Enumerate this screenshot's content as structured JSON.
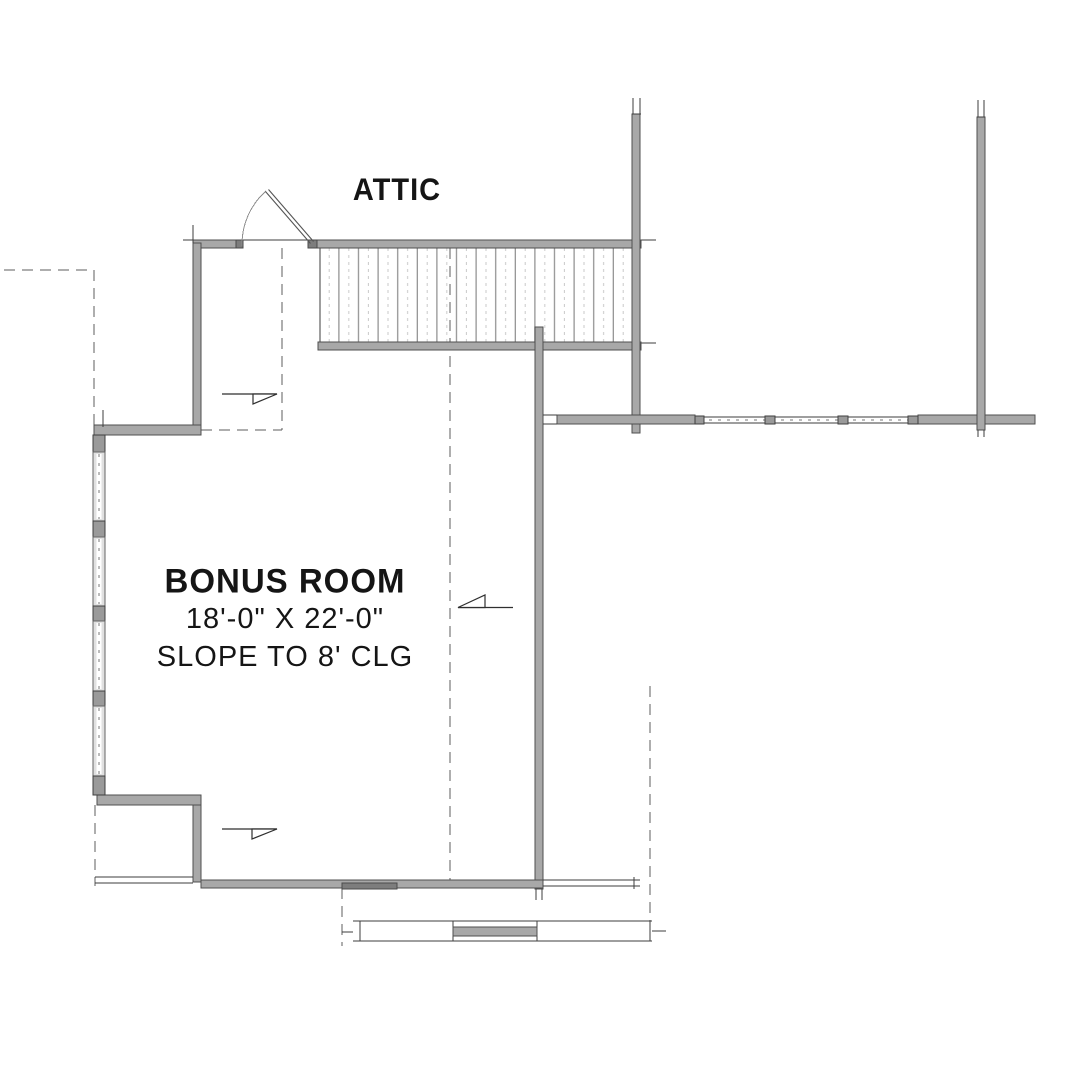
{
  "plan": {
    "attic_label": "ATTIC",
    "room": {
      "name": "BONUS ROOM",
      "dimensions": "18'-0\" X 22'-0\"",
      "ceiling_note": "SLOPE TO 8' CLG"
    }
  },
  "colors": {
    "background": "#ffffff",
    "wall_fill": "#a8a8a8",
    "wall_edge": "#4f4f4f",
    "line": "#3d3d3d",
    "dash": "#5c5c5c",
    "tread": "#8c8c8c",
    "tread_light": "#c9c9c9",
    "glass": "#e0e0e0",
    "text": "#151515"
  }
}
